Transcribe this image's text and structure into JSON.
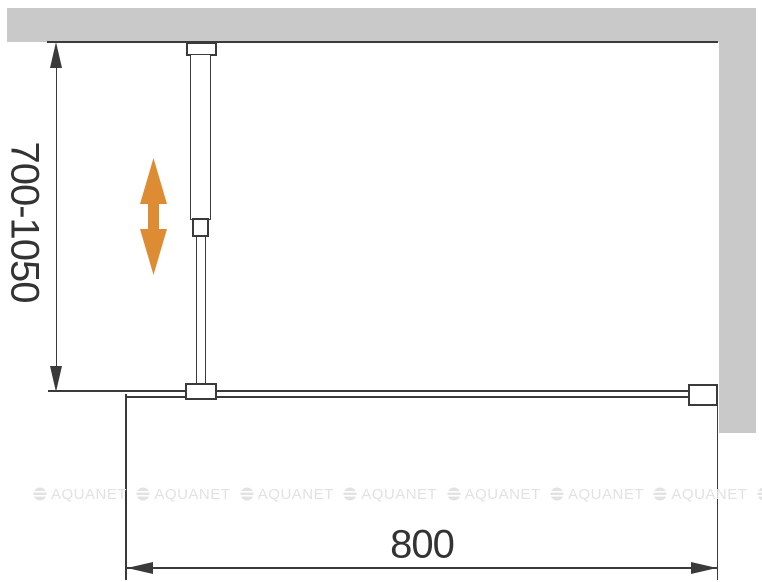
{
  "diagram": {
    "title": "Walk-in shower screen with adjustable support bar — installation diagram",
    "type": "technical-drawing"
  },
  "dimensions": {
    "height_range": {
      "label": "700-1050",
      "orientation": "vertical"
    },
    "width": {
      "label": "800",
      "orientation": "horizontal"
    }
  },
  "parts": {
    "ceiling_bracket": "support-bar ceiling mount",
    "support_bar": "telescopic support bar",
    "glass_clamp": "bar-to-glass clamp",
    "wall_profile": "glass wall profile",
    "glass_panel": "fixed glass panel"
  },
  "adjust_arrow": {
    "meaning": "height adjustability",
    "color": "#de8c33"
  },
  "walls": {
    "color": "#c9c9c9"
  },
  "line_color": "#3a3a3a",
  "watermark": {
    "text": "AQUANET",
    "color": "#e2e2e2",
    "count": 8,
    "start_x": 33,
    "step_x": 103.4
  }
}
